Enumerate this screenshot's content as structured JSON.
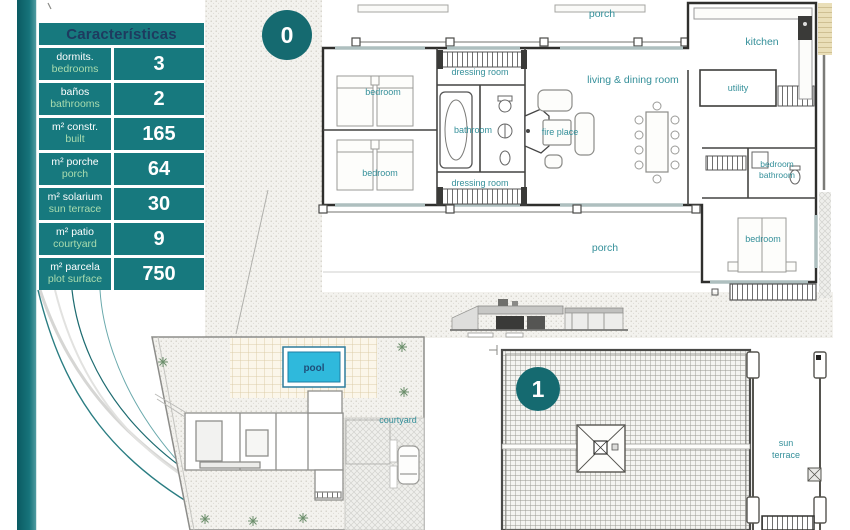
{
  "table": {
    "title": "Características",
    "rows": [
      {
        "es": "dormits.",
        "en": "bedrooms",
        "value": "3"
      },
      {
        "es": "baños",
        "en": "bathrooms",
        "value": "2"
      },
      {
        "es": "m² constr.",
        "en": "built",
        "value": "165"
      },
      {
        "es": "m² porche",
        "en": "porch",
        "value": "64"
      },
      {
        "es": "m² solarium",
        "en": "sun terrace",
        "value": "30"
      },
      {
        "es": "m² patio",
        "en": "courtyard",
        "value": "9"
      },
      {
        "es": "m² parcela",
        "en": "plot surface",
        "value": "750"
      }
    ]
  },
  "badges": {
    "ground": "0",
    "upper": "1"
  },
  "plan_ground": {
    "labels": {
      "porch_top": "porch",
      "dressing_top": "dressing room",
      "bedroom_top": "bedroom",
      "bedroom_bottom": "bedroom",
      "bathroom": "bathroom",
      "fireplace": "fire place",
      "dressing_bottom": "dressing room",
      "living": "living & dining room",
      "kitchen": "kitchen",
      "utility": "utility",
      "bedroom_small": "bedroom",
      "bathroom_small": "bathroom",
      "bedroom_right": "bedroom",
      "porch_bottom": "porch"
    }
  },
  "site_plan": {
    "labels": {
      "pool": "pool",
      "courtyard": "courtyard"
    }
  },
  "roof_plan": {
    "labels": {
      "sun": "sun",
      "terrace": "terrace"
    }
  },
  "colors": {
    "teal_cell": "#17797e",
    "teal_bar": "#0f666d",
    "header_text": "#1e3a5f",
    "label_en_green": "#a9dcae",
    "plan_label_teal": "#35909a",
    "badge_teal": "#156a70",
    "pool_water": "#2fb9dc",
    "pool_text_navy": "#1f4e79"
  }
}
